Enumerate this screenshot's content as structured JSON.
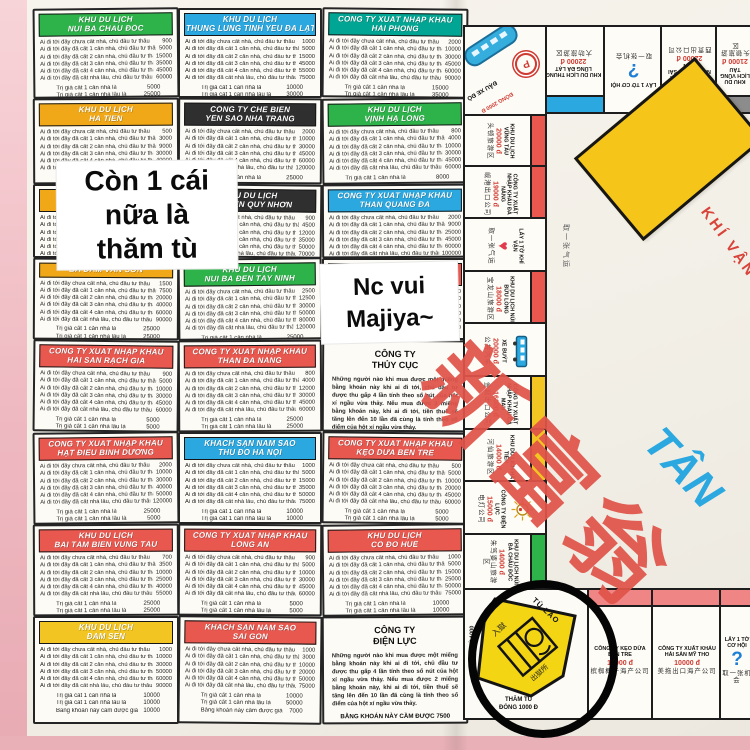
{
  "notes": {
    "note1_lines": [
      "Còn 1 cái",
      "nữa là",
      "thăm tù"
    ],
    "note2_lines": [
      "Nc vui",
      "Majiya~"
    ]
  },
  "colors": {
    "green": "#2eb34a",
    "blue": "#2ba8e0",
    "teal": "#00a693",
    "yellow": "#f0a818",
    "black": "#2f2f2f",
    "red": "#e8584f",
    "gold": "#f2c522",
    "gray": "#8c8c8c",
    "pink": "#ef8585"
  },
  "cards": {
    "rent_lines": [
      "Ai đi tới đây chưa cất nhà, chủ đầu tư thâu",
      "Ai đi tới đây đã cất 1 căn nhà, chủ đầu tư thâu",
      "Ai đi tới đây đã cất 2 căn nhà, chủ đầu tư thâu",
      "Ai đi tới đây đã cất 3 căn nhà, chủ đầu tư thâu",
      "Ai đi tới đây đã cất 4 căn nhà, chủ đầu tư thâu",
      "Ai đi tới đây đã cất nhà lầu, chủ đầu tư thâu"
    ],
    "fee_lines": [
      "Trị giá cất 1 căn nhà là",
      "Trị giá cất 1 căn nhà lầu là",
      "Bằng khoán này cầm được giá"
    ],
    "utility_para": "Những người nào khi mua được một miếng bằng khoán này khi ai đi tới, chủ đầu tư được thu gấp 4 lần tính theo số nút của hột xí ngầu vừa thảy. Nếu mua được 2 miếng bằng khoán này, khi ai đi tới, tiền thuế sẽ tăng lên đến 10 lần đã cùng là tính theo số điểm của hột xí ngầu vừa thảy.",
    "utility_footer": "BẰNG KHOÁN NÀY CẦM ĐƯỢC",
    "grid": [
      {
        "type": "p",
        "h": [
          "KHU DU LỊCH",
          "NÚI BÀ CHÂU ĐỐC"
        ],
        "c": "green",
        "v": [
          900,
          5000,
          15000,
          35000,
          45000,
          60000,
          5000,
          25000,
          3000
        ]
      },
      {
        "type": "p",
        "h": [
          "KHU DU LỊCH",
          "THUNG LŨNG TÌNH YÊU ĐÀ LẠT"
        ],
        "c": "blue",
        "v": [
          1000,
          5000,
          15000,
          45000,
          55000,
          75000,
          10000,
          30000,
          8000
        ]
      },
      {
        "type": "p",
        "h": [
          "CÔNG TY XUẤT NHẬP KHẨU",
          "HẢI PHÒNG"
        ],
        "c": "teal",
        "v": [
          2000,
          10000,
          30000,
          45000,
          60000,
          90000,
          15000,
          35000,
          10000
        ]
      },
      {
        "type": "p",
        "h": [
          "KHU DU LỊCH",
          "HÀ TIÊN"
        ],
        "c": "yellow",
        "v": [
          500,
          3000,
          9000,
          30000,
          40000,
          50000,
          5000,
          20000,
          2500
        ]
      },
      {
        "type": "p",
        "h": [
          "CÔNG TY CHẾ BIẾN",
          "YẾN SÀO NHA TRANG"
        ],
        "c": "black",
        "v": [
          2000,
          10000,
          30000,
          45000,
          60000,
          120000,
          25000,
          25000,
          10000
        ]
      },
      {
        "type": "p",
        "h": [
          "KHU DU LỊCH",
          "VỊNH HẠ LONG"
        ],
        "c": "green",
        "v": [
          800,
          4000,
          10000,
          30000,
          45000,
          60000,
          8000,
          8000,
          4000
        ]
      },
      {
        "type": "p",
        "h": [
          "KHU DU LỊCH",
          "NON NƯỚC ĐÀ NẴNG"
        ],
        "c": "yellow",
        "v": [
          700,
          3500,
          9000,
          25000,
          40000,
          55000,
          5000,
          15000,
          3000
        ]
      },
      {
        "type": "p",
        "h": [
          "KHU DU LỊCH",
          "BÃI BIỂN QUY NHƠN"
        ],
        "c": "black",
        "v": [
          900,
          4500,
          12000,
          35000,
          50000,
          70000,
          10000,
          20000,
          5000
        ]
      },
      {
        "type": "p",
        "h": [
          "CÔNG TY XUẤT NHẬP KHẨU",
          "THAN QUẢNG ĐÀ"
        ],
        "c": "blue",
        "v": [
          2000,
          9000,
          25000,
          45000,
          60000,
          100000,
          10000,
          40000,
          8000
        ]
      },
      {
        "type": "p",
        "h": [
          "BÀ ĐẦM VÂN SƠN"
        ],
        "c": "yellow",
        "v": [
          1500,
          7500,
          20000,
          40000,
          60000,
          90000,
          25000,
          25000,
          10000
        ]
      },
      {
        "type": "p",
        "h": [
          "KHU DU LỊCH",
          "NÚI BÀ ĐEN TÂY NINH"
        ],
        "c": "green",
        "v": [
          2500,
          12500,
          30000,
          50000,
          80000,
          120000,
          25000,
          25000,
          10000
        ]
      },
      {
        "type": "p",
        "h": [
          "KHU DU LỊCH",
          "MŨI NÉ PHAN THIẾT"
        ],
        "c": "red",
        "v": [
          1200,
          6000,
          18000,
          36000,
          54000,
          80000,
          12000,
          24000,
          6000
        ]
      },
      {
        "type": "p",
        "h": [
          "CÔNG TY XUẤT NHẬP KHẨU",
          "HẢI SẢN RẠCH GIÁ"
        ],
        "c": "red",
        "v": [
          900,
          5000,
          10000,
          30000,
          45000,
          60000,
          5000,
          5000,
          3000
        ]
      },
      {
        "type": "p",
        "h": [
          "CÔNG TY XUẤT NHẬP KHẨU",
          "THAN ĐÀ NẴNG"
        ],
        "c": "red",
        "v": [
          800,
          4000,
          12000,
          30000,
          45000,
          60000,
          25000,
          25000,
          10000
        ]
      },
      {
        "type": "u",
        "h": [
          "CÔNG TY",
          "THỦY CỤC"
        ],
        "fv": 7500
      },
      {
        "type": "p",
        "h": [
          "CÔNG TY XUẤT NHẬP KHẨU",
          "HẠT ĐIỀU BÌNH DƯƠNG"
        ],
        "c": "red",
        "v": [
          2000,
          10000,
          30000,
          40000,
          50000,
          120000,
          25000,
          5000,
          10000
        ]
      },
      {
        "type": "p",
        "h": [
          "KHÁCH SẠN NĂM SAO",
          "THỦ ĐÔ HÀ NỘI"
        ],
        "c": "blue",
        "v": [
          1000,
          5000,
          15000,
          35000,
          50000,
          75000,
          10000,
          10000,
          7000
        ]
      },
      {
        "type": "p",
        "h": [
          "CÔNG TY XUẤT NHẬP KHẨU",
          "KẸO DỪA BẾN TRE"
        ],
        "c": "red",
        "v": [
          500,
          5000,
          10000,
          20000,
          45000,
          60000,
          5000,
          5000,
          20000
        ]
      },
      {
        "type": "p",
        "h": [
          "KHU DU LỊCH",
          "BÃI TẮM BIỂN VŨNG TÀU"
        ],
        "c": "red",
        "v": [
          700,
          3500,
          10000,
          25000,
          40000,
          55000,
          25000,
          25000,
          10000
        ]
      },
      {
        "type": "p",
        "h": [
          "CÔNG TY XUẤT NHẬP KHẨU",
          "LONG AN"
        ],
        "c": "red",
        "v": [
          900,
          5000,
          10000,
          30000,
          45000,
          60000,
          5000,
          5000,
          3000
        ]
      },
      {
        "type": "p",
        "h": [
          "KHU DU LỊCH",
          "CỐ ĐÔ HUẾ"
        ],
        "c": "red",
        "v": [
          1000,
          5000,
          15000,
          25000,
          50000,
          75000,
          10000,
          10000,
          7000
        ]
      },
      {
        "type": "p",
        "h": [
          "KHU DU LỊCH",
          "ĐẦM SEN"
        ],
        "c": "gold",
        "v": [
          1000,
          10000,
          30000,
          50000,
          60000,
          90000,
          10000,
          10000,
          10000
        ]
      },
      {
        "type": "p",
        "h": [
          "KHÁCH SẠN NĂM SAO",
          "SÀI GÒN"
        ],
        "c": "red",
        "v": [
          1000,
          3000,
          10000,
          20000,
          50000,
          75000,
          10000,
          50000,
          7000
        ]
      },
      {
        "type": "u",
        "h": [
          "CÔNG TY",
          "ĐIỆN LỰC"
        ],
        "fv": 7500
      }
    ]
  },
  "board": {
    "title_cn": "新富翁",
    "title_vn": "TÂN",
    "center_diamond": {
      "label": "KHÍ VẬN",
      "cn": "取一张气运"
    },
    "corner_top_left": {
      "label": "ĐẬU XE ĐÒ",
      "fee": "ĐÓNG 2000 Đ",
      "p": "P"
    },
    "corner_jail": {
      "label": "TÙ LAO",
      "cn_in": "入獄",
      "cn_out": "出獄所",
      "visit": "THĂM TÙ",
      "fee": "ĐÓNG 1000 Đ",
      "side": "THĂM TÙ 1000"
    },
    "top_row": [
      {
        "name": "KHU DU LỊCH THUNG LŨNG ĐÀ LẠT",
        "price": "22000 đ",
        "cn": "大叻旅游区",
        "bar": "#2ba8e0"
      },
      {
        "name": "LẤY 1 TỜ CƠ HỘI",
        "cn": "取一张机会",
        "icon": "?"
      },
      {
        "name": "CÔNG TY XUẤT NHẬP KHẨU SÀI GÒN",
        "price": "22000 đ",
        "cn": "西贡出口公司",
        "bar": "#8c8c8c"
      },
      {
        "name": "KHU DU LỊCH VŨNG TÀU",
        "price": "21000 đ",
        "cn": "头顿旅游区",
        "bar": "#8c8c8c"
      }
    ],
    "left_col": [
      {
        "name": "KHU DU LỊCH VŨNG TÀU",
        "price": "20000 đ",
        "cn": "头顿旅游区",
        "bar": "#e8584f"
      },
      {
        "name": "CÔNG TY XUẤT NHẬP KHẨU ĐÀ NẴNG",
        "price": "19000 đ",
        "cn": "岘港出口公司",
        "bar": "#e8584f"
      },
      {
        "name": "LẤY 1 TỜ KHÍ VẬN",
        "cn": "取一张气运",
        "icon": "heart"
      },
      {
        "name": "KHU DU LỊCH NÚI BỬU LONG",
        "price": "18000 đ",
        "cn": "宝龙山旅游区",
        "bar": "#e8584f"
      },
      {
        "name": "XE BUÝT",
        "price": "20000 đ",
        "cn": "公共汽车",
        "icon": "bus"
      },
      {
        "name": "CÔNG TY XUẤT NHẬP KHẨU CÀ MAU",
        "price": "16000 đ",
        "cn": "金瓯出口公司",
        "bar": "#f2c522"
      },
      {
        "name": "KHU DU LỊCH HÀ TIÊN",
        "price": "14000 đ",
        "cn": "河仙旅游区",
        "bar": "#f2c522"
      },
      {
        "name": "CÔNG TY ĐIỆN LỰC",
        "price": "15000 đ",
        "cn": "电灯公司",
        "icon": "bulb"
      },
      {
        "name": "KHU DU LỊCH NÚI BÀ CHÂU ĐỐC",
        "price": "14000 đ",
        "cn": "朱笃婆山旅游区",
        "bar": "#2eb34a"
      }
    ],
    "bottom_row": [
      {
        "name": "CÔNG TY KẸO DỪA BẾN TRE",
        "price": "12000 đ",
        "cn": "槟椥椰子海产公司",
        "bar": "#ef8585"
      },
      {
        "name": "CÔNG TY XUẤT KHẨU HẢI SẢN MỸ THO",
        "price": "10000 đ",
        "cn": "美拖出口海产公司",
        "bar": "#ef8585"
      },
      {
        "name": "LẤY 1 TỜ CƠ HỘI",
        "cn": "取一张机会",
        "icon": "?",
        "bar": "#ef8585"
      }
    ]
  }
}
